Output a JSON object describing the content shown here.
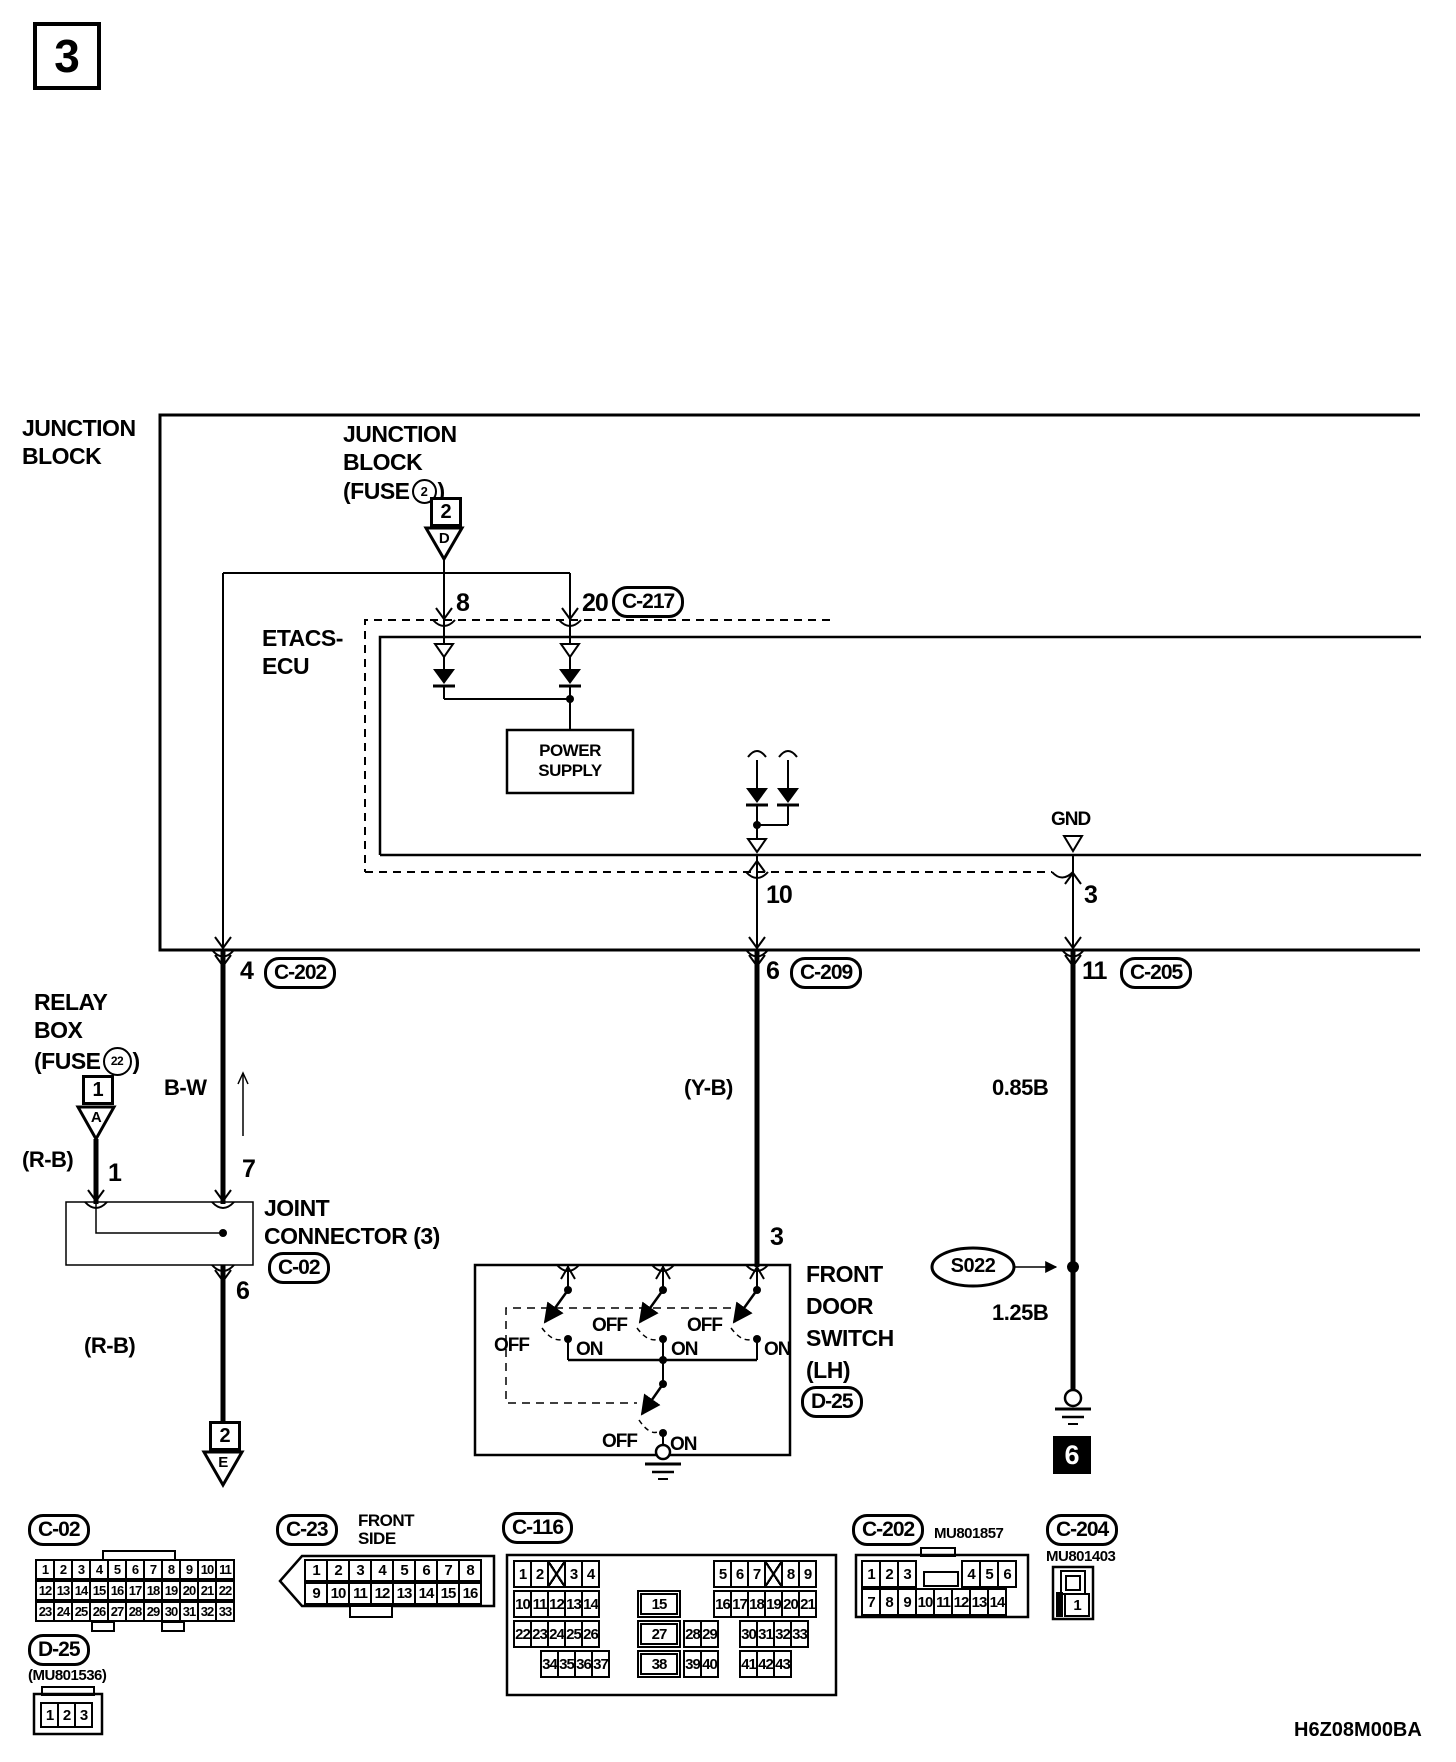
{
  "page": {
    "tag": "3",
    "code": "H6Z08M00BA"
  },
  "junction_block_label": {
    "line1": "JUNCTION",
    "line2": "BLOCK"
  },
  "jb_fuse": {
    "line1": "JUNCTION",
    "line2": "BLOCK",
    "fuse_open": "(FUSE",
    "fuse_num": "2",
    "fuse_close": ")",
    "slot": "2",
    "triangle_letter": "D"
  },
  "etacs": {
    "name1": "ETACS-",
    "name2": "ECU",
    "ps1": "POWER",
    "ps2": "SUPPLY",
    "gnd": "GND",
    "pin8": "8",
    "pin20": "20",
    "pin10": "10",
    "pin3": "3",
    "c217": "C-217"
  },
  "relay": {
    "line1": "RELAY",
    "line2": "BOX",
    "fuse_open": "(FUSE",
    "fuse_num": "22",
    "fuse_close": ")",
    "slot": "1",
    "triangle_letter": "A",
    "color": "(R-B)",
    "pin1": "1"
  },
  "wire_bw": {
    "pin4": "4",
    "c202": "C-202",
    "color": "B-W",
    "pin7": "7",
    "pin6": "6",
    "color2": "(R-B)",
    "slot": "2",
    "triangle_letter": "E"
  },
  "wire_yb": {
    "pin6": "6",
    "c209": "C-209",
    "color": "(Y-B)",
    "pin3": "3"
  },
  "wire_gnd": {
    "pin11": "11",
    "c205": "C-205",
    "size1": "0.85B",
    "splice": "S022",
    "size2": "1.25B",
    "ground_tag": "6"
  },
  "joint": {
    "line1": "JOINT",
    "line2": "CONNECTOR (3)",
    "badge": "C-02"
  },
  "door_switch": {
    "line1": "FRONT",
    "line2": "DOOR",
    "line3": "SWITCH",
    "line4": "(LH)",
    "badge": "D-25",
    "off": "OFF",
    "on": "ON"
  },
  "bottom": {
    "c02": {
      "badge": "C-02",
      "rows": [
        [
          "1",
          "2",
          "3",
          "4",
          "5",
          "6",
          "7",
          "8",
          "9",
          "10",
          "11"
        ],
        [
          "12",
          "13",
          "14",
          "15",
          "16",
          "17",
          "18",
          "19",
          "20",
          "21",
          "22"
        ],
        [
          "23",
          "24",
          "25",
          "26",
          "27",
          "28",
          "29",
          "30",
          "31",
          "32",
          "33"
        ]
      ]
    },
    "d25": {
      "badge": "D-25",
      "part": "(MU801536)",
      "cells": [
        "1",
        "2",
        "3"
      ]
    },
    "c23": {
      "badge": "C-23",
      "side1": "FRONT",
      "side2": "SIDE",
      "rows": [
        [
          "1",
          "2",
          "3",
          "4",
          "5",
          "6",
          "7",
          "8"
        ],
        [
          "9",
          "10",
          "11",
          "12",
          "13",
          "14",
          "15",
          "16"
        ]
      ]
    },
    "c116": {
      "badge": "C-116",
      "r1l": [
        "1",
        "2",
        "X",
        "3",
        "4"
      ],
      "r1r": [
        "5",
        "6",
        "7",
        "X",
        "8",
        "9"
      ],
      "r2l": [
        "10",
        "11",
        "12",
        "13",
        "14"
      ],
      "r2c": [
        "15"
      ],
      "r2r": [
        "16",
        "17",
        "18",
        "19",
        "20",
        "21"
      ],
      "r3l": [
        "22",
        "23",
        "24",
        "25",
        "26"
      ],
      "r3c": [
        "27"
      ],
      "r3c2": [
        "28",
        "29"
      ],
      "r3r": [
        "30",
        "31",
        "32",
        "33"
      ],
      "r4l": [
        "34",
        "35",
        "36",
        "37"
      ],
      "r4c": [
        "38"
      ],
      "r4c2": [
        "39",
        "40"
      ],
      "r4r": [
        "41",
        "42",
        "43"
      ]
    },
    "c202": {
      "badge": "C-202",
      "part": "MU801857",
      "r1l": [
        "1",
        "2",
        "3"
      ],
      "r1r": [
        "4",
        "5",
        "6"
      ],
      "r2": [
        "7",
        "8",
        "9",
        "10",
        "11",
        "12",
        "13",
        "14"
      ]
    },
    "c204": {
      "badge": "C-204",
      "part": "MU801403",
      "cell": "1"
    }
  }
}
